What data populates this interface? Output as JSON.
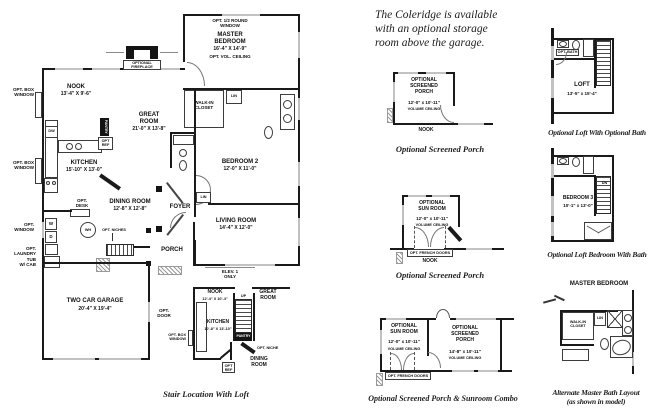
{
  "note": {
    "line1": "The Coleridge is available",
    "line2": "with an optional storage",
    "line3": "room above the garage."
  },
  "main": {
    "opt_half_round_window": "OPT. 1/2 ROUND\nWINDOW",
    "master": {
      "name": "MASTER\nBEDROOM",
      "dims": "16'-4\" X 14'-9\"",
      "note": "OPT. VOL. CEILING"
    },
    "optional_fireplace": "OPTIONAL\nFIREPLACE",
    "nook": {
      "name": "NOOK",
      "dims": "13'-4\" X 9'-6\""
    },
    "great_room": {
      "name": "GREAT\nROOM",
      "dims": "21'-0\" X 13'-8\""
    },
    "kitchen": {
      "name": "KITCHEN",
      "dims": "15'-10\" X 13'-0\""
    },
    "dining_room": {
      "name": "DINING ROOM",
      "dims": "12'-8\" X 12'-8\""
    },
    "bedroom2": {
      "name": "BEDROOM 2",
      "dims": "12'-0\" X 11'-0\""
    },
    "living_room": {
      "name": "LIVING ROOM",
      "dims": "14'-4\" X 12'-0\""
    },
    "garage": {
      "name": "TWO CAR GARAGE",
      "dims": "20'-4\" X 19'-4\""
    },
    "foyer": "FOYER",
    "porch": "PORCH",
    "walk_in_closet": "WALK-IN\nCLOSET",
    "lin_1": "LIN",
    "lin_2": "LIN",
    "elev": "ELEV. 1\nONLY",
    "opt_box_window_1": "OPT. BOX\nWINDOW",
    "opt_box_window_2": "OPT. BOX\nWINDOW",
    "opt_window": "OPT.\nWINDOW",
    "opt_laundry": "OPT.\nLAUNDRY\nTUB\nW/ CAB",
    "opt_desk": "OPT.\nDESK",
    "opt_ref": "OPT\nREF",
    "opt_niches": "OPT. NICHES",
    "opt_door": "OPT.\nDOOR",
    "pantry": "PANTRY",
    "dw": "DW",
    "w": "W",
    "d": "D",
    "wh": "WH"
  },
  "stair_plan": {
    "caption": "Stair Location With Loft",
    "nook": {
      "name": "NOOK",
      "dims": "12'-4\" X 10'-4\""
    },
    "great_room": "GREAT\nROOM",
    "kitchen": {
      "name": "KITCHEN",
      "dims": "10'-8\" X 13'-10\""
    },
    "dining_room": "DINING\nROOM",
    "up": "UP",
    "pantry": "PANTRY",
    "opt_box_window": "OPT. BOX\nWINDOW",
    "opt_ref": "OPT\nREF",
    "opt_niche": "OPT. NICHE"
  },
  "porch_plan": {
    "room": "OPTIONAL\nSCREENED\nPORCH",
    "dims": "12'-0\" x 10'-11\"",
    "volume": "VOLUME CEILING",
    "nook": "NOOK",
    "caption": "Optional Screened Porch"
  },
  "sunroom_plan": {
    "room": "OPTIONAL\nSUN ROOM",
    "dims": "12'-0\" x 10'-11\"",
    "volume": "VOLUME CEILING",
    "french_doors": "OPT. FRENCH DOORS",
    "nook": "NOOK",
    "caption": "Optional Screened Porch"
  },
  "combo_plan": {
    "sun_room": "OPTIONAL\nSUN ROOM",
    "sun_dims": "12'-0\" x 10'-11\"",
    "sun_volume": "VOLUME CEILING",
    "french_doors": "OPT. FRENCH DOORS",
    "porch": "OPTIONAL\nSCREENED\nPORCH",
    "porch_dims": "14'-8\" x 10'-11\"",
    "porch_volume": "VOLUME CEILING",
    "caption": "Optional Screened Porch & Sunroom Combo"
  },
  "loft_plan": {
    "name": "LOFT",
    "dims": "13'-5\" x 15'-4\"",
    "opt_bath": "OPT. BATH",
    "caption": "Optional Loft With Optional Bath"
  },
  "bedroom3_plan": {
    "name": "BEDROOM 3",
    "dims": "10'-1\" x 13'-0\"",
    "dn": "DN",
    "caption": "Optional Loft Bedroom With Bath"
  },
  "master_bath_plan": {
    "header": "MASTER BEDROOM",
    "walk_in_closet": "WALK-IN\nCLOSET",
    "lin": "LIN",
    "caption_1": "Alternate Master Bath Layout",
    "caption_2": "(as shown in model)"
  }
}
